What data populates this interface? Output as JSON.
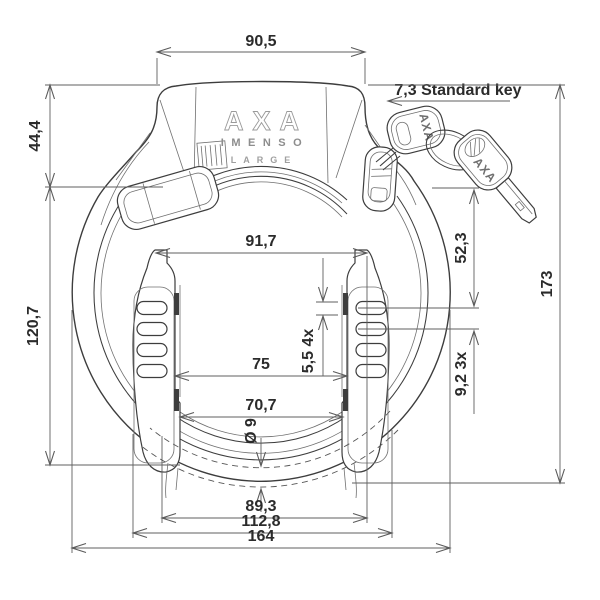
{
  "brand": {
    "logo": "AXA",
    "model": "IMENSO",
    "size": "LARGE",
    "key1": "AXA",
    "key2": "AXA"
  },
  "dimensions": {
    "top_width": "90,5",
    "upper_left_height": "44,4",
    "key_note": "7,3 Standard key",
    "overall_height": "173",
    "cylinder_to_ribs": "52,3",
    "opening_top_width": "91,7",
    "lower_left_height": "120,7",
    "opening_width": "75",
    "rib_height": "5,5 4x",
    "rib_pitch": "9,2 3x",
    "opening_bottom_width": "70,7",
    "bolt_diameter": "Ø 9",
    "bottom_span_inner": "89,3",
    "bottom_span_mid": "112,8",
    "overall_width": "164"
  }
}
